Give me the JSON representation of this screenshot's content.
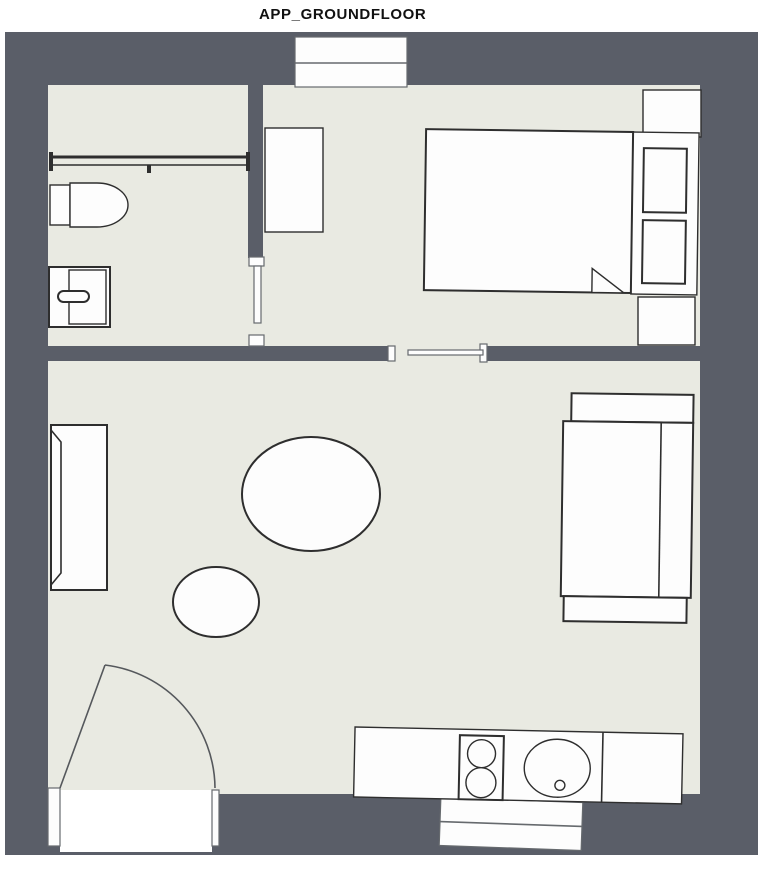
{
  "title": "APP_GROUNDFLOOR",
  "colors": {
    "wall": "#5a5e68",
    "floor": "#e9eae2",
    "furniture": "#fdfdfd",
    "outline": "#2e2e2e",
    "outline_light": "#666a6e",
    "background": "#ffffff",
    "title_text": "#111111"
  },
  "plan": {
    "rooms": [
      "bathroom",
      "bedroom",
      "living-room-kitchen"
    ],
    "fixtures": [
      "toilet",
      "sink-cabinet",
      "shower-screen",
      "bathroom-door",
      "window-top",
      "desk",
      "bed",
      "pillows",
      "nightstand-top",
      "nightstand-bottom",
      "sliding-door",
      "wardrobe-sideboard",
      "dining-table",
      "stool",
      "sofa",
      "entrance-door",
      "kitchen-counter",
      "stove",
      "kitchen-sink",
      "window-bottom"
    ]
  }
}
